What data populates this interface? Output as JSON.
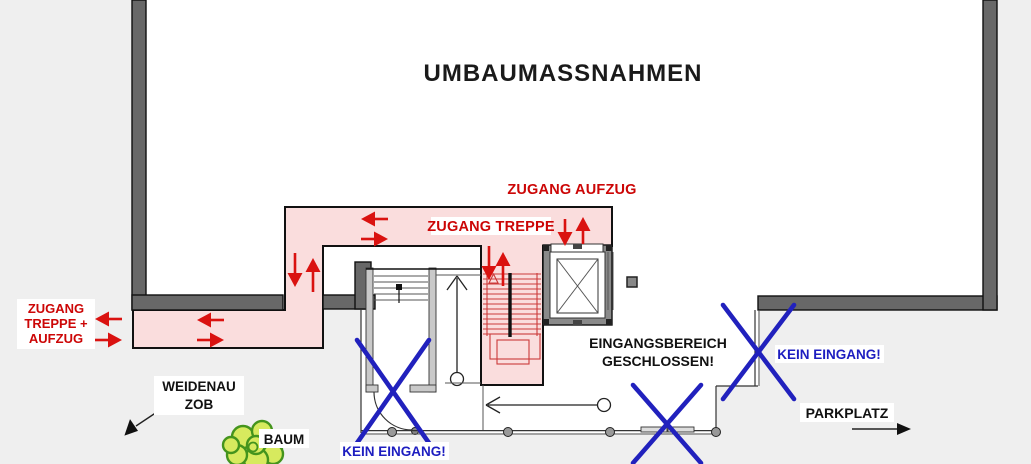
{
  "plan": {
    "title": "UMBAUMASSNAHMEN",
    "routes": {
      "elevator_access": "ZUGANG AUFZUG",
      "stair_access": "ZUGANG TREPPE",
      "stair_elevator_line1": "ZUGANG",
      "stair_elevator_line2": "TREPPE +",
      "stair_elevator_line3": "AUFZUG"
    },
    "closures": {
      "entrance_closed_line1": "EINGANGSBEREICH",
      "entrance_closed_line2": "GESCHLOSSEN!",
      "no_entry_east": "KEIN EINGANG!",
      "no_entry_south": "KEIN EINGANG!"
    },
    "surroundings": {
      "parking": "PARKPLATZ",
      "bus_station_line1": "WEIDENAU",
      "bus_station_line2": "ZOB",
      "tree": "BAUM"
    },
    "colors": {
      "background": "#efefef",
      "interior": "#ffffff",
      "wall": "#686868",
      "route_highlight": "#fadddd",
      "arrow_red": "#da1210",
      "label_red": "#cc0606",
      "no_entry_blue": "#2121bd",
      "tree_green_fill": "#d7ea5e",
      "tree_green_stroke": "#44941d"
    }
  }
}
